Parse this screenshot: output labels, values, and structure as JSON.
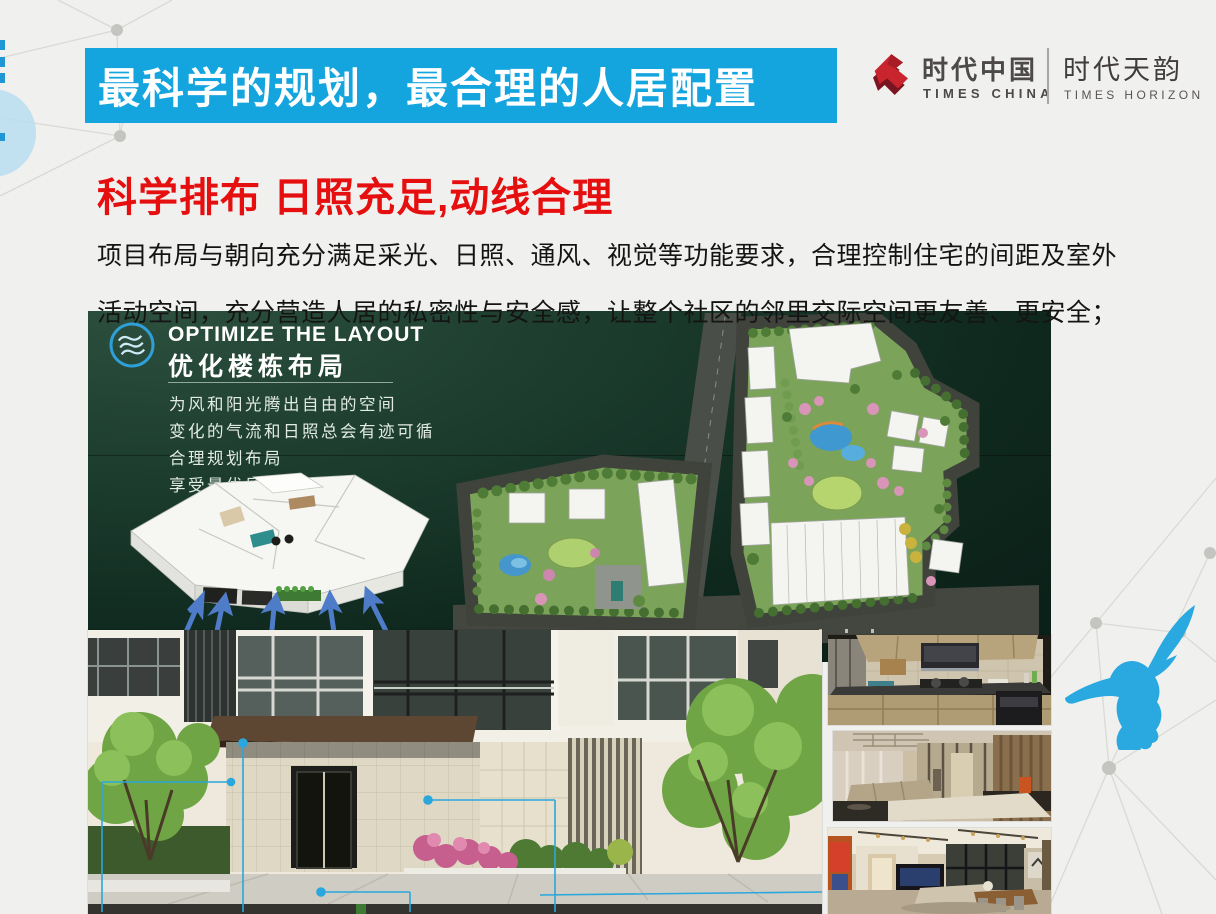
{
  "slide": {
    "banner": {
      "title": "最科学的规划，最合理的人居配置"
    },
    "brand": {
      "company_cn": "时代中国",
      "company_en": "TIMES CHINA",
      "project_cn": "时代天韵",
      "project_en": "TIMES HORIZON"
    },
    "heading": "科学排布 日照充足,动线合理",
    "body": {
      "line1": "项目布局与朝向充分满足采光、日照、通风、视觉等功能要求，合理控制住宅的间距及室外",
      "line2": "活动空间，充分营造人居的私密性与安全感，让整个社区的邻里交际空间更友善、更安全；"
    },
    "feature": {
      "title_en": "OPTIMIZE THE LAYOUT",
      "title_cn": "优化楼栋布局",
      "lines": [
        "为风和阳光腾出自由的空间",
        "变化的气流和日照总会有迹可循",
        "合理规划布局",
        "享受最优风热气候"
      ]
    },
    "images": {
      "panel_background": "dark-green-gradient",
      "floorplan": "3d-floorplan-model",
      "masterplan": "site-master-plan",
      "entrance": "building-entrance-rendering",
      "kitchen": "kitchen-interior-photo",
      "living1": "living-room-interior-photo",
      "living2": "living-dining-interior-photo"
    },
    "icons": {
      "wind": "wind-waves-icon",
      "brand": "times-china-logo-icon",
      "bird": "hummingbird-logo"
    },
    "colors": {
      "banner_bg": "#14a4de",
      "heading_red": "#e60f0f",
      "logo_red": "#c9252f",
      "hummingbird_blue": "#29a9e0",
      "panel_green_dark": "#0b2018",
      "panel_green_light": "#2c4f3e",
      "background": "#f0f0ee"
    }
  }
}
